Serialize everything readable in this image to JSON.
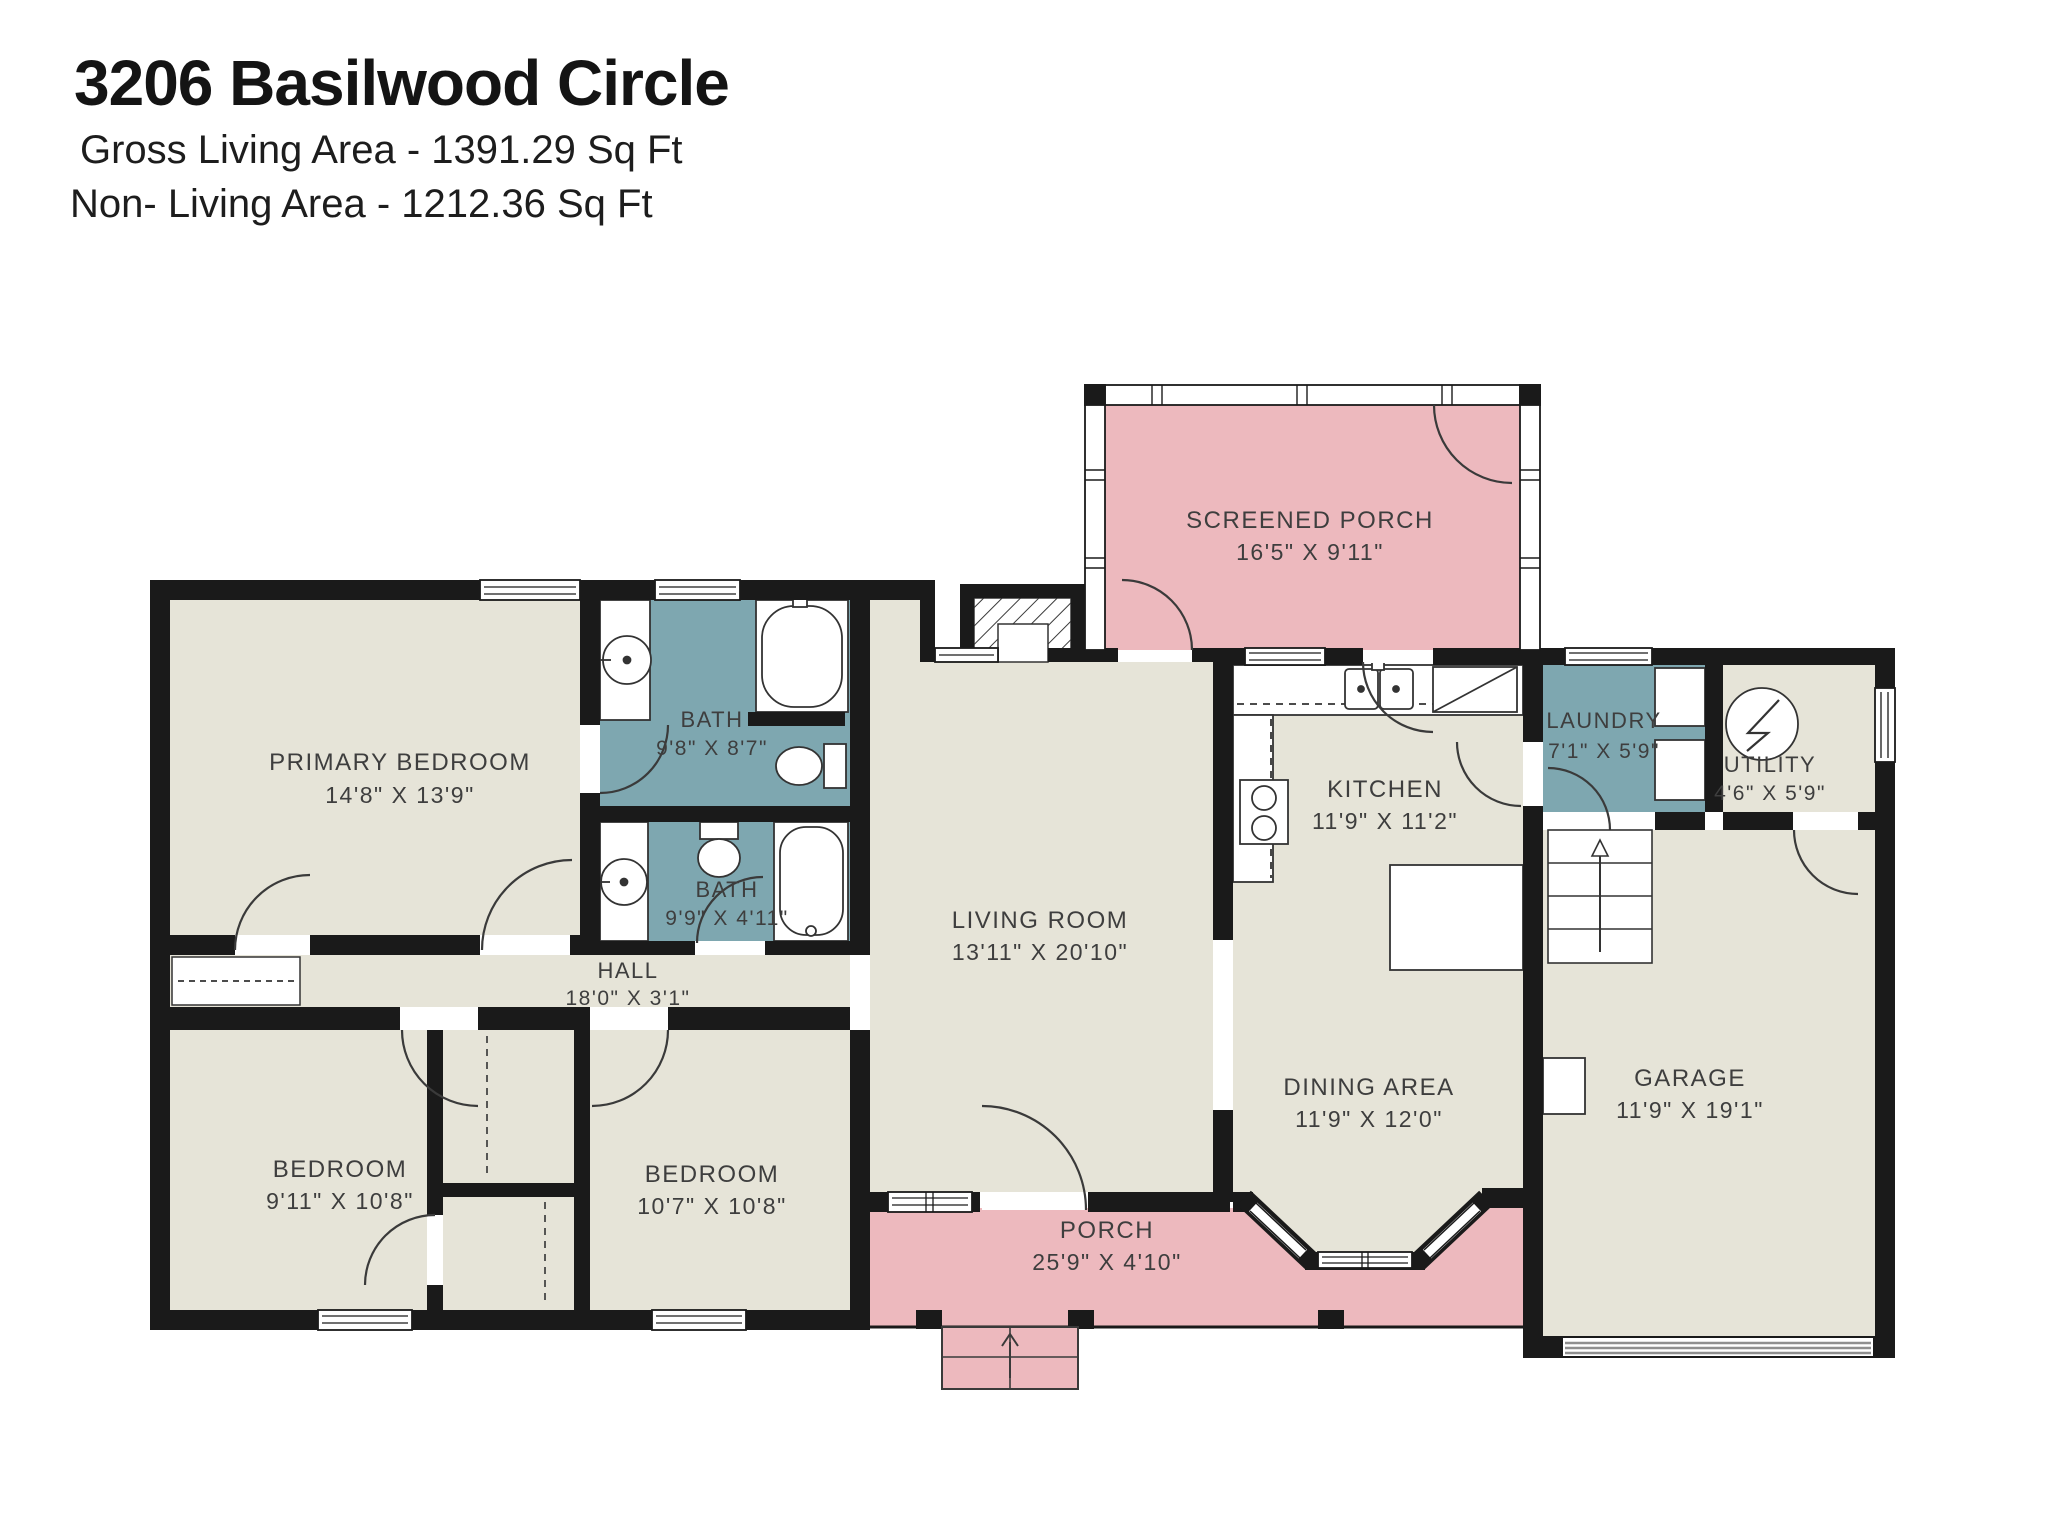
{
  "title": "3206 Basilwood Circle",
  "subtitle_gross": "Gross Living Area - 1391.29 Sq Ft",
  "subtitle_nonliving": "Non- Living Area - 1212.36 Sq Ft",
  "rooms": {
    "screened_porch": {
      "name": "SCREENED PORCH",
      "dims": "16'5\" X 9'11\""
    },
    "primary_bedroom": {
      "name": "PRIMARY BEDROOM",
      "dims": "14'8\" X 13'9\""
    },
    "bath_main": {
      "name": "BATH",
      "dims": "9'8\" X 8'7\""
    },
    "bath_hall": {
      "name": "BATH",
      "dims": "9'9\" X 4'11\""
    },
    "hall": {
      "name": "HALL",
      "dims": "18'0\" X 3'1\""
    },
    "living_room": {
      "name": "LIVING ROOM",
      "dims": "13'11\" X 20'10\""
    },
    "kitchen": {
      "name": "KITCHEN",
      "dims": "11'9\" X 11'2\""
    },
    "laundry": {
      "name": "LAUNDRY",
      "dims": "7'1\" X 5'9\""
    },
    "utility": {
      "name": "UTILITY",
      "dims": "4'6\" X 5'9\""
    },
    "dining_area": {
      "name": "DINING AREA",
      "dims": "11'9\" X 12'0\""
    },
    "garage": {
      "name": "GARAGE",
      "dims": "11'9\" X 19'1\""
    },
    "bedroom_left": {
      "name": "BEDROOM",
      "dims": "9'11\" X 10'8\""
    },
    "bedroom_right": {
      "name": "BEDROOM",
      "dims": "10'7\" X 10'8\""
    },
    "porch": {
      "name": "PORCH",
      "dims": "25'9\" X 4'10\""
    }
  },
  "colors": {
    "wall": "#1a1a1a",
    "room_fill": "#e6e4d8",
    "wet_room_fill": "#7ea7b0",
    "porch_fill": "#edb9be",
    "label_text": "#3e3e3e"
  }
}
